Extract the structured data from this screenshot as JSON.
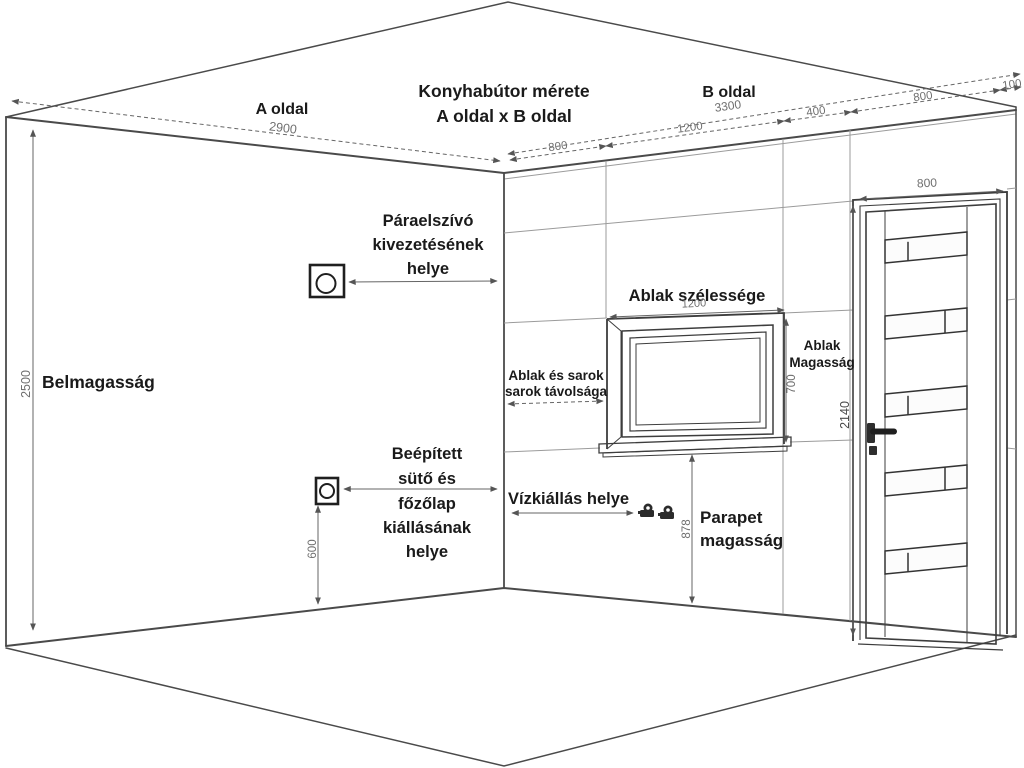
{
  "title": {
    "line1": "Konyhabútor mérete",
    "line2": "A oldal x B oldal"
  },
  "walls": {
    "a_side": {
      "label": "A oldal",
      "dim": "2900"
    },
    "b_side": {
      "label": "B oldal",
      "dim": "3300",
      "segments": [
        "800",
        "1200",
        "400",
        "800",
        "100"
      ]
    },
    "height": {
      "label": "Belmagasság",
      "dim": "2500"
    }
  },
  "window": {
    "width_label": "Ablak szélessége",
    "width_dim": "1200",
    "height_label_line1": "Ablak",
    "height_label_line2": "Magasság",
    "height_dim": "700",
    "corner_label_line1": "Ablak és sarok",
    "corner_label_line2": "sarok távolsága",
    "parapet_label_line1": "Parapet",
    "parapet_label_line2": "magasság",
    "parapet_dim": "878"
  },
  "door": {
    "width_dim": "800",
    "height_dim": "2140"
  },
  "annotations": {
    "extractor": {
      "line1": "Páraelszívó",
      "line2": "kivezetésének",
      "line3": "helye"
    },
    "oven": {
      "line1": "Beépített",
      "line2": "sütő és",
      "line3": "főzőlap",
      "line4": "kiállásának",
      "line5": "helye",
      "dim": "600"
    },
    "water": {
      "label": "Vízkiállás helye"
    }
  },
  "colors": {
    "main_lines": "#4a4a4a",
    "grid_lines": "#9b9b9b",
    "text": "#1a1a1a",
    "dim_text": "#6f6f6f"
  }
}
